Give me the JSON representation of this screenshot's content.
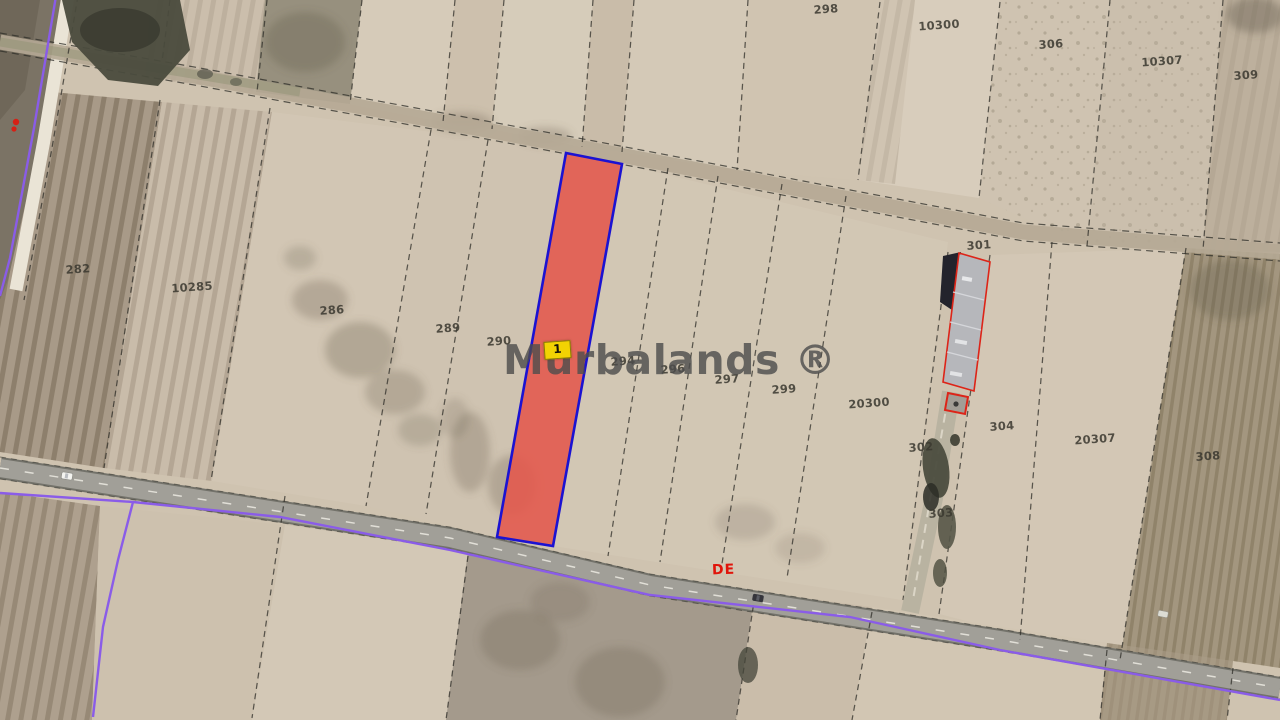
{
  "watermark": {
    "text": "Murbalands ®"
  },
  "selected_parcel": {
    "marker_label": "1",
    "fill": "#e4584c",
    "border_color": "#1b12d2",
    "marker_bg": "#f2d303"
  },
  "road_label": {
    "text": "DE",
    "color": "#e0140a"
  },
  "parcel_labels": [
    {
      "text": "282",
      "x": 78,
      "y": 269
    },
    {
      "text": "10285",
      "x": 192,
      "y": 287
    },
    {
      "text": "286",
      "x": 332,
      "y": 310
    },
    {
      "text": "289",
      "x": 448,
      "y": 328
    },
    {
      "text": "290",
      "x": 499,
      "y": 341
    },
    {
      "text": "294",
      "x": 623,
      "y": 361
    },
    {
      "text": "296",
      "x": 673,
      "y": 369
    },
    {
      "text": "297",
      "x": 727,
      "y": 379
    },
    {
      "text": "299",
      "x": 784,
      "y": 389
    },
    {
      "text": "298",
      "x": 826,
      "y": 9
    },
    {
      "text": "10300",
      "x": 939,
      "y": 25
    },
    {
      "text": "306",
      "x": 1051,
      "y": 44
    },
    {
      "text": "10307",
      "x": 1162,
      "y": 61
    },
    {
      "text": "309",
      "x": 1246,
      "y": 75
    },
    {
      "text": "301",
      "x": 979,
      "y": 245
    },
    {
      "text": "20300",
      "x": 869,
      "y": 403
    },
    {
      "text": "302",
      "x": 921,
      "y": 447
    },
    {
      "text": "303",
      "x": 941,
      "y": 513
    },
    {
      "text": "304",
      "x": 1002,
      "y": 426
    },
    {
      "text": "20307",
      "x": 1095,
      "y": 439
    },
    {
      "text": "308",
      "x": 1208,
      "y": 456
    }
  ],
  "colors": {
    "watermark": "#4c4c4c",
    "marker-bg": "#f2d303",
    "road-label": "#e0140a",
    "parcel-fill": "#e4584c",
    "parcel-border": "#1b12d2",
    "purple-line": "#8a5ce8",
    "base-ground": "#cfc3b0",
    "road-asphalt": "#a19f98",
    "building-roof": "#b6b7bb",
    "building-outline": "#dd2418"
  }
}
